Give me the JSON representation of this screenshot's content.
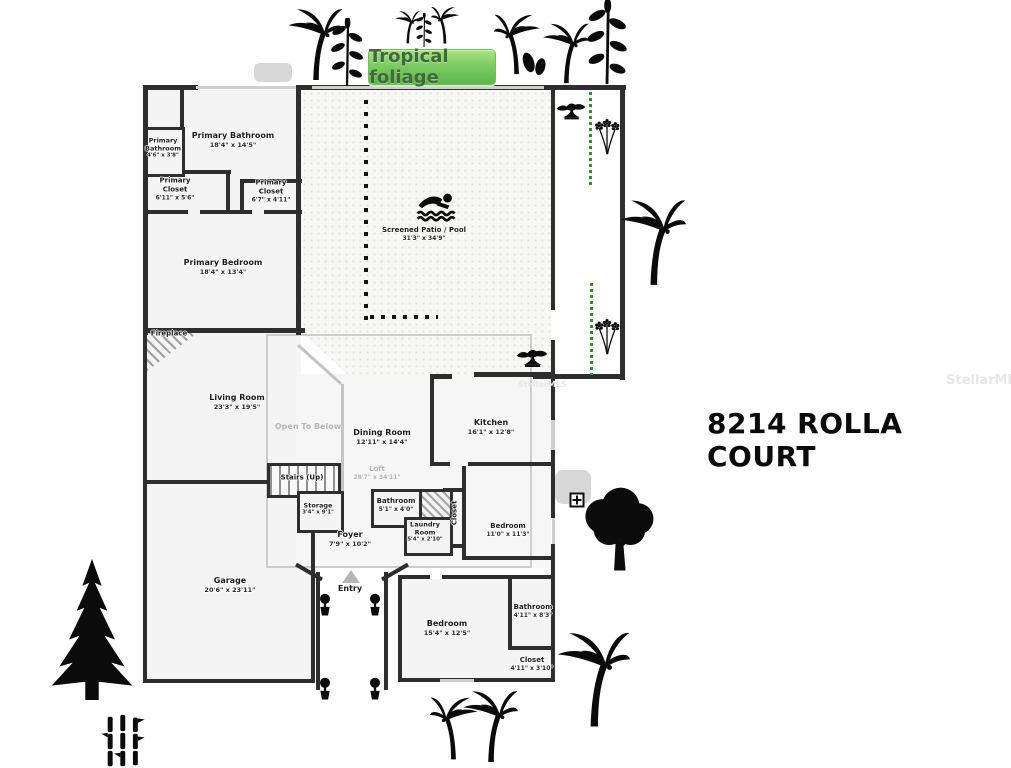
{
  "title": "8214 ROLLA COURT",
  "badge": {
    "label": "Tropical foliage"
  },
  "watermark": {
    "label": "StellarMLS"
  },
  "colors": {
    "badge_green": "#6abf4b",
    "badge_text": "#41693b",
    "hedge_green": "#2f8f2f",
    "wall": "#2e2e2e",
    "room_fill": "#f4f4f4",
    "window_gray": "#cfcfcf",
    "muted_label": "#b7b7b7"
  },
  "plan": {
    "rooms": {
      "primary_bathroom_small": {
        "name": "Primary Bathroom",
        "dims": "4'6\" x 3'8\""
      },
      "primary_bathroom": {
        "name": "Primary Bathroom",
        "dims": "18'4\" x 14'5\""
      },
      "primary_closet_left": {
        "name": "Primary Closet",
        "dims": "6'11\" x 5'6\""
      },
      "primary_closet_right": {
        "name": "Primary Closet",
        "dims": "6'7\" x 4'11\""
      },
      "primary_bedroom": {
        "name": "Primary Bedroom",
        "dims": "18'4\" x 13'4\""
      },
      "screened_patio_pool": {
        "name": "Screened Patio / Pool",
        "dims": "31'3\" x 34'9\""
      },
      "fireplace": {
        "name": "Fireplace"
      },
      "living_room": {
        "name": "Living Room",
        "dims": "23'3\" x 19'5\""
      },
      "open_to_below": {
        "name": "Open To Below"
      },
      "dining_room": {
        "name": "Dining Room",
        "dims": "12'11\" x 14'4\""
      },
      "kitchen": {
        "name": "Kitchen",
        "dims": "16'1\" x 12'8\""
      },
      "stairs": {
        "name": "Stairs (Up)"
      },
      "loft": {
        "name": "Loft",
        "dims": "28'7\" x 34'11\""
      },
      "storage": {
        "name": "Storage",
        "dims": "3'4\" x 9'1\""
      },
      "bathroom_half": {
        "name": "Bathroom",
        "dims": "5'1\" x 4'0\""
      },
      "laundry_room": {
        "name": "Laundry Room",
        "dims": "5'4\" x 2'10\""
      },
      "closet_hall": {
        "name": "Closet"
      },
      "foyer": {
        "name": "Foyer",
        "dims": "7'9\" x 10'2\""
      },
      "bedroom_mid": {
        "name": "Bedroom",
        "dims": "11'0\" x 11'3\""
      },
      "garage": {
        "name": "Garage",
        "dims": "20'6\" x 23'11\""
      },
      "entry": {
        "name": "Entry"
      },
      "bedroom_lower": {
        "name": "Bedroom",
        "dims": "15'4\" x 12'5\""
      },
      "bathroom_lower": {
        "name": "Bathroom",
        "dims": "4'11\" x 8'3\""
      },
      "closet_lower": {
        "name": "Closet",
        "dims": "4'11\" x 3'10\""
      }
    }
  },
  "decorations": [
    "palm-tree-icon",
    "pine-tree-icon",
    "bamboo-icon",
    "bonsai-icon",
    "flowers-icon",
    "leafy-branch-icon",
    "leaf-pair-icon",
    "deciduous-tree-icon",
    "swimmer-icon",
    "topiary-icon",
    "north-arrow-icon",
    "plus-marker-icon",
    "hedge-dotted-line",
    "measure-dotted-line",
    "equipment-pad"
  ]
}
